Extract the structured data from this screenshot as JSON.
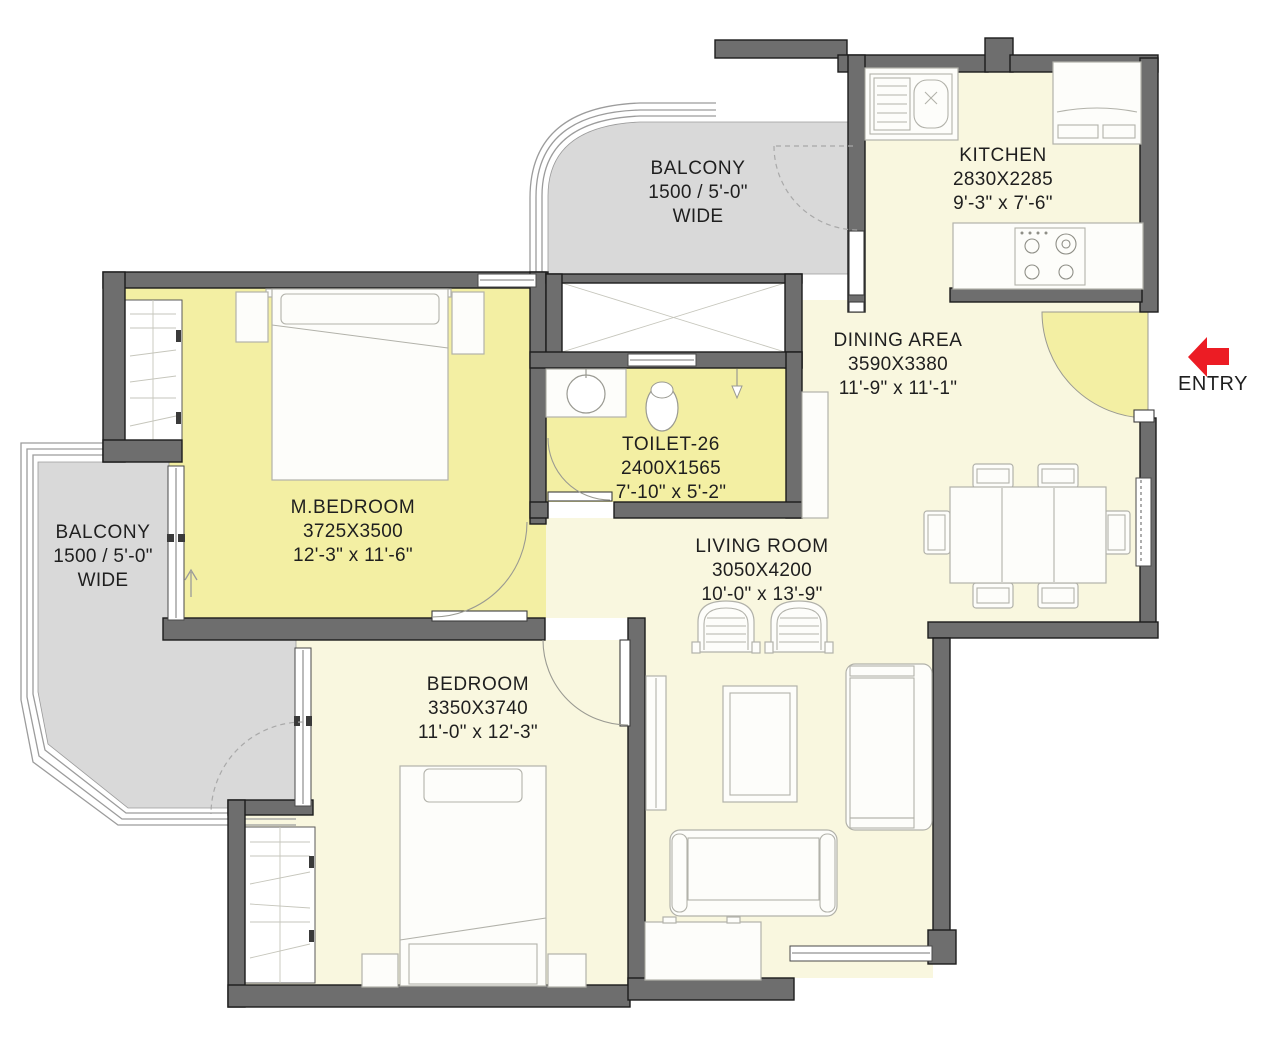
{
  "rooms": {
    "balcony_top": {
      "name": "BALCONY",
      "size": "1500 / 5'-0\"",
      "note": "WIDE"
    },
    "kitchen": {
      "name": "KITCHEN",
      "dims_mm": "2830X2285",
      "dims_ft": "9'-3\" x 7'-6\""
    },
    "dining": {
      "name": "DINING AREA",
      "dims_mm": "3590X3380",
      "dims_ft": "11'-9\" x 11'-1\""
    },
    "mbedroom": {
      "name": "M.BEDROOM",
      "dims_mm": "3725X3500",
      "dims_ft": "12'-3\" x 11'-6\""
    },
    "toilet": {
      "name": "TOILET-26",
      "dims_mm": "2400X1565",
      "dims_ft": "7'-10\" x 5'-2\""
    },
    "living": {
      "name": "LIVING ROOM",
      "dims_mm": "3050X4200",
      "dims_ft": "10'-0\" x 13'-9\""
    },
    "bedroom": {
      "name": "BEDROOM",
      "dims_mm": "3350X3740",
      "dims_ft": "11'-0\" x 12'-3\""
    },
    "balcony_left": {
      "name": "BALCONY",
      "size": "1500 / 5'-0\"",
      "note": "WIDE"
    }
  },
  "entry": {
    "label": "ENTRY"
  },
  "colors": {
    "wall": "#6e6e6e",
    "wall_outline": "#1c1c1c",
    "balcony": "#d9d9d9",
    "floor": "#f9f7df",
    "floor_accent": "#f3efa3",
    "furniture": "#fdfdfa",
    "furniture_stroke": "#b2b2aa",
    "railing": "#9c9c9c",
    "entry_arrow": "#ec1c24",
    "text": "#1f1f1f",
    "dash": "#a9a9a9"
  },
  "icons": {
    "entry_arrow": "left-arrow"
  }
}
